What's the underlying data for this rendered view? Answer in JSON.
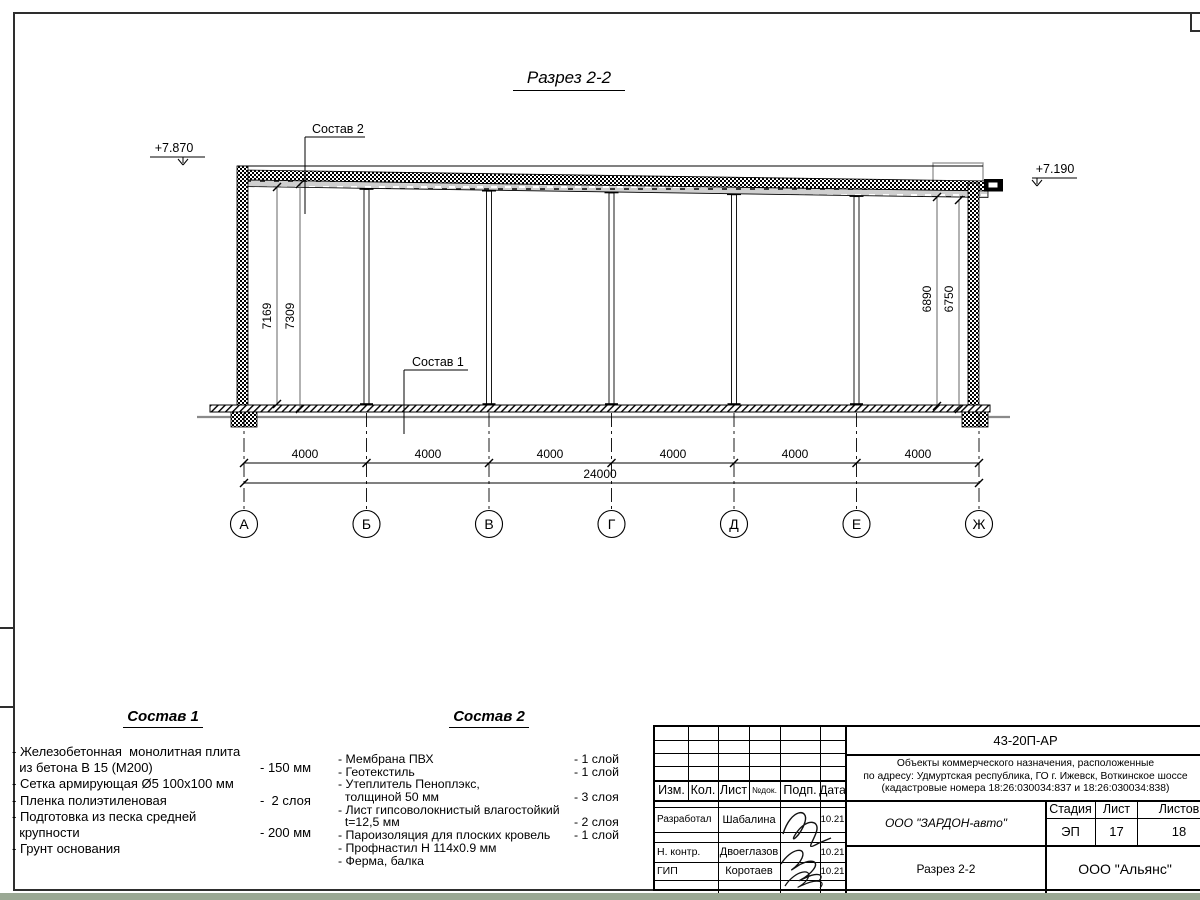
{
  "colors": {
    "ground_line": "#8a8a8a",
    "bottom_strip": "#9aa894",
    "paper": "#ffffff",
    "ink": "#000000"
  },
  "drawing": {
    "title": "Разрез 2-2",
    "elevation_left": "+7.870",
    "elevation_right": "+7.190",
    "leader_roof": "Состав 2",
    "leader_floor": "Состав 1",
    "dim_left_inner": "7169",
    "dim_left_outer": "7309",
    "dim_right_inner": "6890",
    "dim_right_outer": "6750",
    "span_dims": [
      "4000",
      "4000",
      "4000",
      "4000",
      "4000",
      "4000"
    ],
    "total_dim": "24000",
    "axes": [
      "А",
      "Б",
      "В",
      "Г",
      "Д",
      "Е",
      "Ж"
    ]
  },
  "comp1": {
    "title": "Состав 1",
    "lines": [
      {
        "text": "- Железобетонная  монолитная плита",
        "value": ""
      },
      {
        "text": "  из бетона В 15 (М200)",
        "value": "- 150 мм"
      },
      {
        "text": "- Сетка армирующая Ø5 100x100 мм",
        "value": ""
      },
      {
        "text": "- Пленка полиэтиленовая",
        "value": "-  2 слоя"
      },
      {
        "text": "- Подготовка из песка средней",
        "value": ""
      },
      {
        "text": "  крупности",
        "value": "- 200 мм"
      },
      {
        "text": "- Грунт основания",
        "value": ""
      }
    ]
  },
  "comp2": {
    "title": "Состав 2",
    "lines": [
      {
        "text": "- Мембрана ПВХ",
        "value": "- 1 слой"
      },
      {
        "text": "- Геотекстиль",
        "value": "- 1 слой"
      },
      {
        "text": "- Утеплитель Пеноплэкс,",
        "value": ""
      },
      {
        "text": "  толщиной 50 мм",
        "value": "- 3 слоя"
      },
      {
        "text": "- Лист гипсоволокнистый влагостойкий",
        "value": ""
      },
      {
        "text": "  t=12,5 мм",
        "value": "- 2 слоя"
      },
      {
        "text": "- Пароизоляция для плоских кровель",
        "value": "- 1 слой"
      },
      {
        "text": "- Профнастил Н 114x0.9 мм",
        "value": ""
      },
      {
        "text": "- Ферма, балка",
        "value": ""
      }
    ]
  },
  "titleblock": {
    "doc_code": "43-20П-АР",
    "address1": "Объекты коммерческого назначения, расположенные",
    "address2": "по адресу: Удмуртская республика, ГО г. Ижевск, Воткинское шоссе",
    "address3": "(кадастровые номера 18:26:030034:837 и 18:26:030034:838)",
    "col_izm": "Изм.",
    "col_kol": "Кол.",
    "col_list": "Лист",
    "col_ndok": "№док.",
    "col_podp": "Подп.",
    "col_data": "Дата",
    "row1_role": "Разработал",
    "row1_name": "Шабалина",
    "row1_date": "10.21",
    "row2_role": "Н. контр.",
    "row2_name": "Двоеглазов",
    "row2_date": "10.21",
    "row3_role": "ГИП",
    "row3_name": "Коротаев",
    "row3_date": "10.21",
    "company": "ООО \"ЗАРДОН-авто\"",
    "stage_label": "Стадия",
    "sheet_label": "Лист",
    "sheets_label": "Листов",
    "stage": "ЭП",
    "sheet": "17",
    "sheets": "18",
    "doc_name": "Разрез 2-2",
    "firm": "ООО \"Альянс\""
  }
}
